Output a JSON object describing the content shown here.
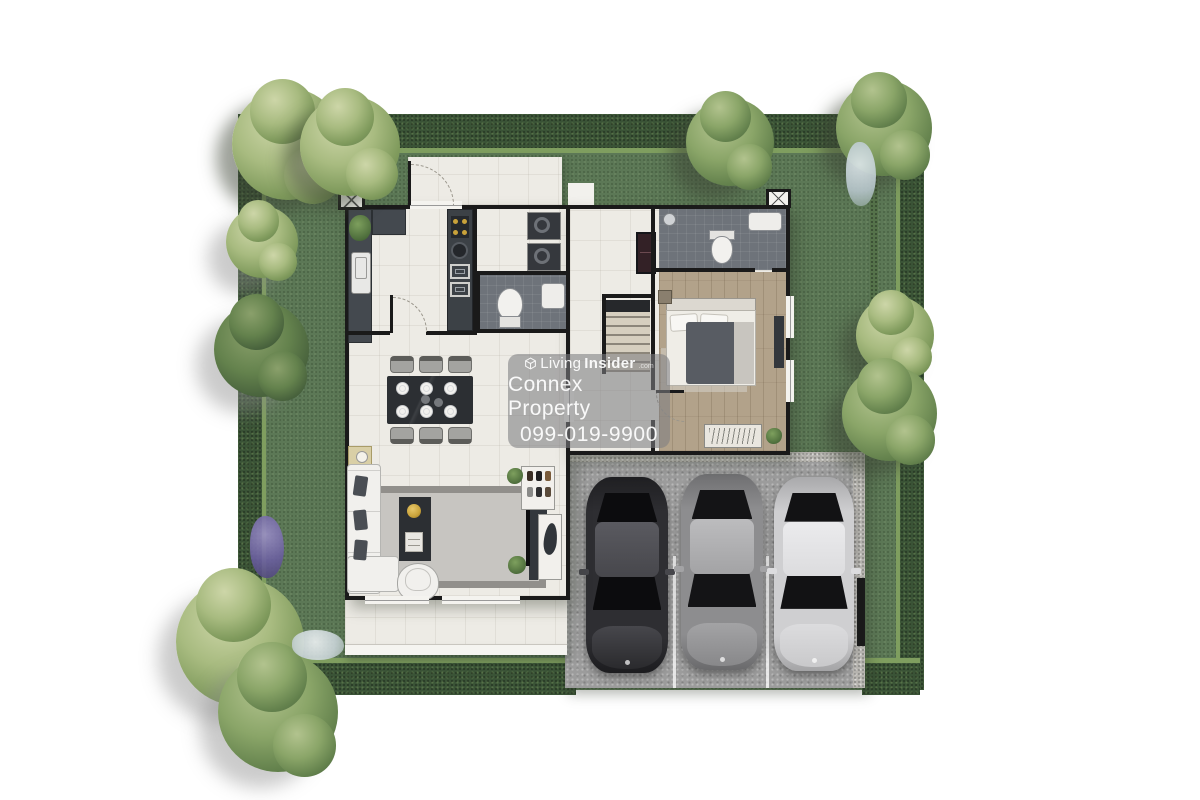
{
  "watermark": {
    "logo_icon": "living-insider-cube-icon",
    "brand_first": "Living",
    "brand_second": "Insider",
    "brand_suffix": ".com",
    "company": "Connex Property",
    "phone": "099-019-9900",
    "panel_color": "rgba(125,126,130,0.58)",
    "text_color": "#ffffff"
  },
  "palette": {
    "page_bg": "#ffffff",
    "lawn_green": "#5c7856",
    "hedge_green": "#3a5336",
    "hedge_highlight": "#7f9e5f",
    "wall_black": "#1a1a1a",
    "floor_white": "#edebe5",
    "wood_floor": "#b2a28a",
    "bathroom_gray": "#6e737a",
    "counter_dark": "#44494f",
    "garage_gray": "#9c9c9c",
    "car_dark": "#2a2a2d",
    "car_gray": "#88888a",
    "car_silver": "#c9c9cb",
    "accent_gold": "#c9a23a"
  }
}
